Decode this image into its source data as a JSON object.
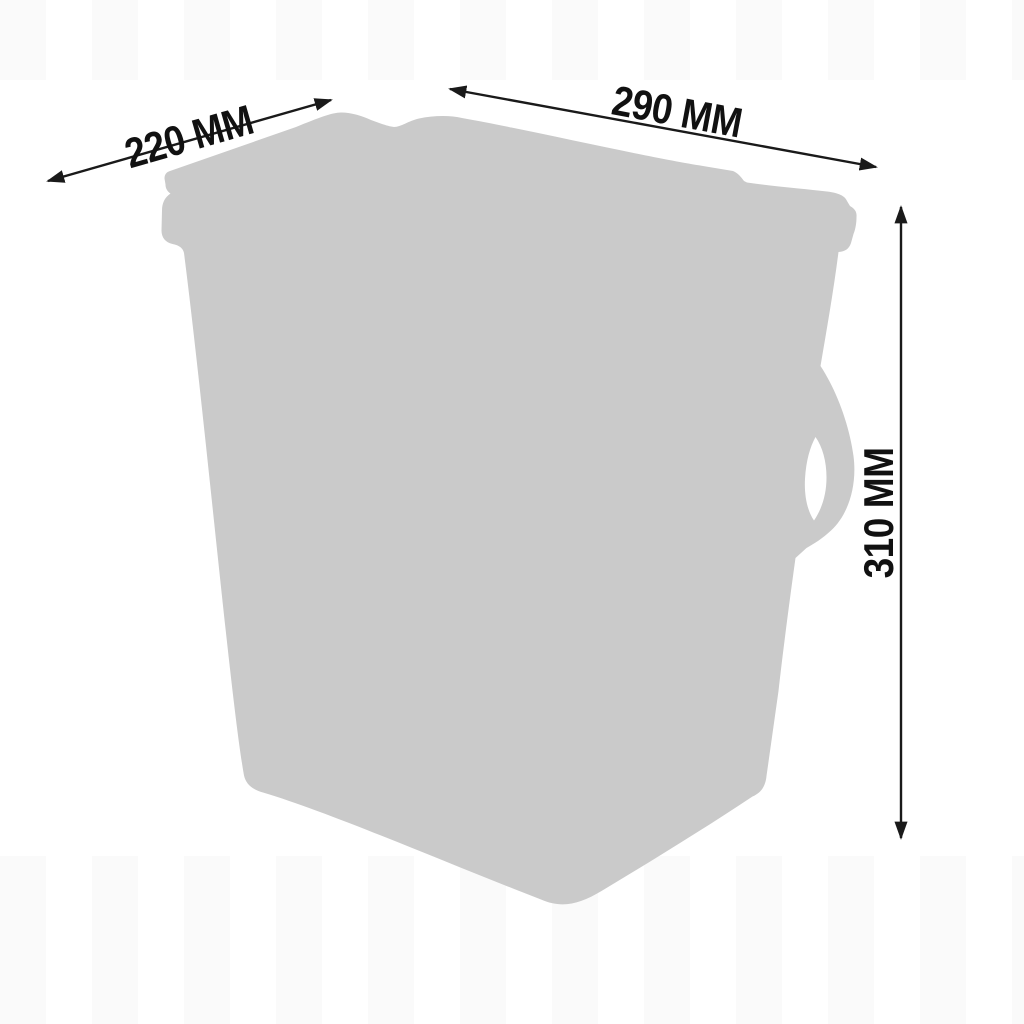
{
  "diagram": {
    "object": "storage-container-silhouette",
    "view": "three-quarter-perspective",
    "colors": {
      "silhouette": "#cacaca",
      "dimension_lines": "#1a1a1a",
      "label_text": "#111111",
      "background": "#ffffff",
      "watermark_stripe": "rgba(0,0,0,0.018)"
    },
    "icons": [
      "double-arrow-icon",
      "double-arrow-icon",
      "double-arrow-icon"
    ],
    "dimensions": [
      {
        "id": "depth",
        "label": "220 MM"
      },
      {
        "id": "width",
        "label": "290 MM"
      },
      {
        "id": "height",
        "label": "310 MM"
      }
    ]
  }
}
